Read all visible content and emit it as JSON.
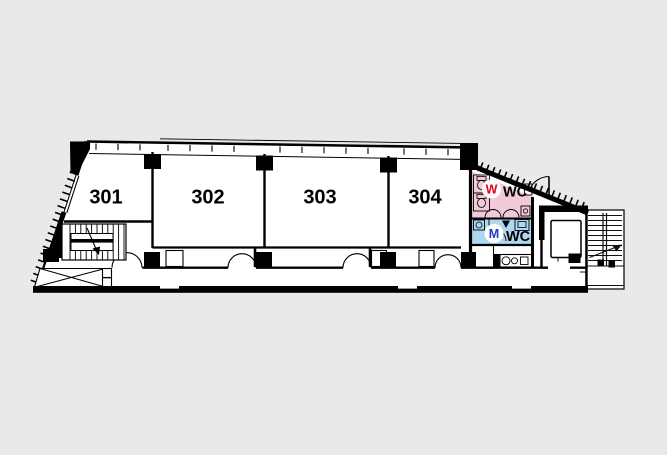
{
  "canvas": {
    "bg": "#e9e9e9",
    "ink": "#000000",
    "floor": "#ffffff"
  },
  "rooms": [
    {
      "label": "301"
    },
    {
      "label": "302"
    },
    {
      "label": "303"
    },
    {
      "label": "304"
    }
  ],
  "restrooms": {
    "women": {
      "letter": "W",
      "label": "WC",
      "letter_color": "#e4001e",
      "bg": "#f2c9d8"
    },
    "men": {
      "letter": "M",
      "label": "WC",
      "letter_color": "#1f3cc3",
      "bg": "#aed6f0"
    }
  }
}
